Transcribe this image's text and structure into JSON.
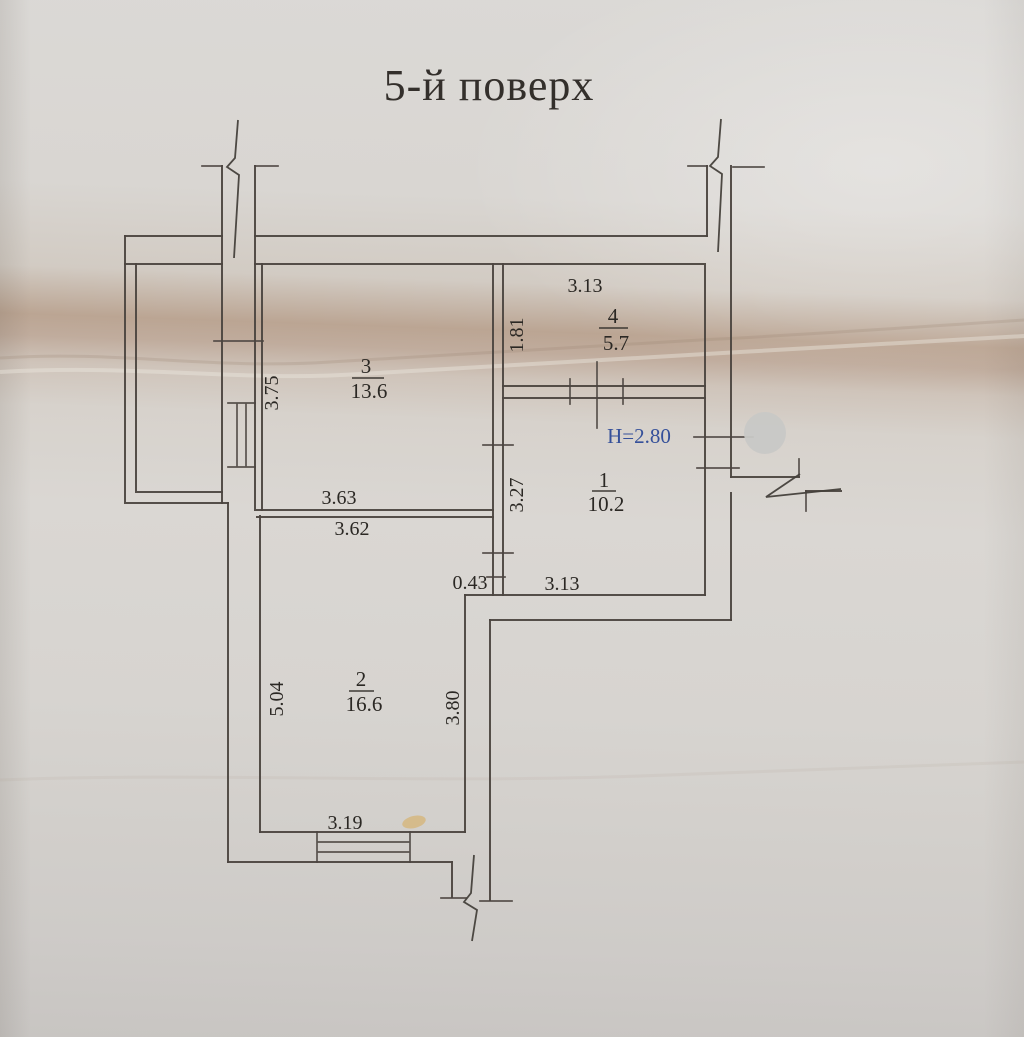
{
  "floor_plan": {
    "title": "5-й поверх",
    "ceiling_height_label": "H=2.80",
    "rooms": [
      {
        "number": "1",
        "area": "10.2"
      },
      {
        "number": "2",
        "area": "16.6"
      },
      {
        "number": "3",
        "area": "13.6"
      },
      {
        "number": "4",
        "area": "5.7"
      }
    ],
    "dimensions": {
      "room4_width": "3.13",
      "room4_height": "1.81",
      "room3_height": "3.75",
      "room3_width": "3.63",
      "room2_width_top": "3.62",
      "room1_height": "3.27",
      "wall_offset": "0.43",
      "room1_width": "3.13",
      "room2_height_left": "5.04",
      "room2_height_right": "3.80",
      "room2_width_bottom": "3.19"
    },
    "colors": {
      "paper": "#d8d5d1",
      "crease": "#bba593",
      "line_ink": "#4b4540",
      "text_ink": "#2b2824",
      "height_note_ink": "#35509a",
      "privacy_dot": "#c8c8c6"
    }
  }
}
